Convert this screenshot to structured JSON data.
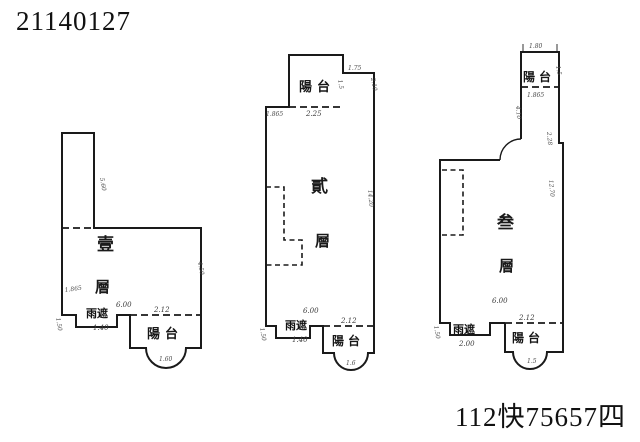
{
  "page": {
    "top_left_number": "21140127",
    "bottom_right_number": "112快75657四"
  },
  "colors": {
    "ink": "#1a1a1a",
    "pencil": "#3a3a3a",
    "paper": "#ffffff"
  },
  "plan1": {
    "floor_top": "壹",
    "floor_bottom": "層",
    "balcony": "陽台",
    "canopy": "雨遮",
    "dim_width": "6.00",
    "dim_canopy": "1.40",
    "dim_balcony": "2.12",
    "dim_strip_inner": "1.865",
    "dim_strip_side": "5.60",
    "dim_right_side": "4.50",
    "dim_left_side": "1.50",
    "dim_arc": "1.60"
  },
  "plan2": {
    "floor_top": "貳",
    "floor_bottom": "層",
    "balcony_top": "陽台",
    "balcony_bottom": "陽台",
    "canopy": "雨遮",
    "dim_balcony_top": "2.25",
    "dim_top_left": "1.865",
    "dim_top_right": "1.75",
    "dim_top_right_side": "2.10",
    "dim_balcony_side": "1.5",
    "dim_right_side": "14.20",
    "dim_width": "6.00",
    "dim_canopy": "1.40",
    "dim_balcony": "2.12",
    "dim_left_side": "1.50",
    "dim_arc": "1.6"
  },
  "plan3": {
    "floor_top": "叁",
    "floor_bottom": "層",
    "balcony_top": "陽台",
    "balcony_bottom": "陽台",
    "canopy": "雨遮",
    "dim_balcony_top_width": "1.80",
    "dim_balcony_top": "1.865",
    "dim_balcony_side": "1.5",
    "dim_corridor_left": "4.10",
    "dim_corridor_right": "2.28",
    "dim_right_side": "12.70",
    "dim_width": "6.00",
    "dim_canopy": "2.00",
    "dim_balcony": "2.12",
    "dim_left_side": "1.50",
    "dim_arc": "1.5"
  }
}
